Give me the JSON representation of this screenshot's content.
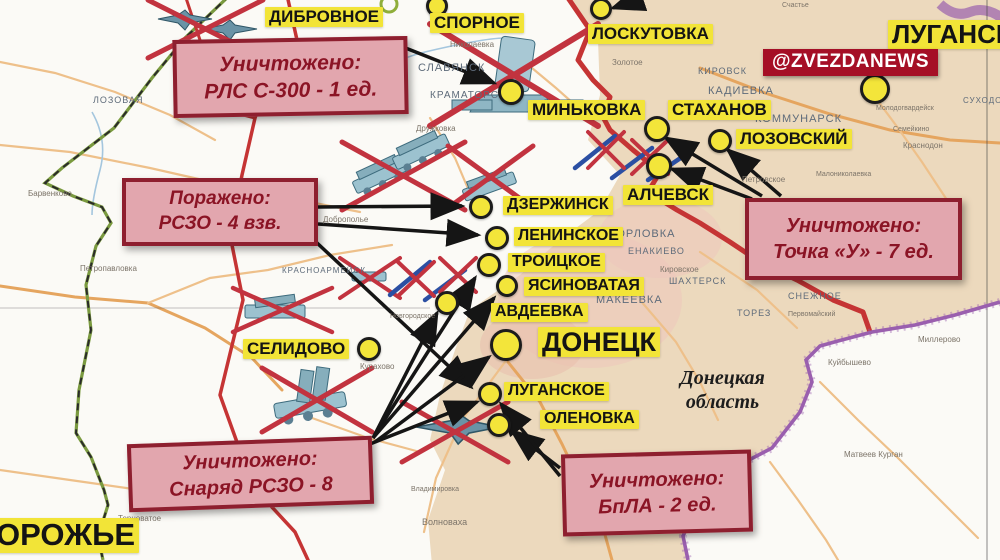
{
  "watermark": {
    "text": "@ZVEZDANEWS"
  },
  "corner_labels": {
    "top_right": "ЛУГАНСК",
    "bottom_left": "ОРОЖЬЕ"
  },
  "region_note": {
    "line1": "Донецкая",
    "line2": "область"
  },
  "colors": {
    "label_yellow": "#f2e437",
    "callout_bg": "#e2a6ae",
    "callout_border": "#8e1f2f",
    "callout_text": "#8b1425",
    "badge_bg": "#a50f26",
    "front_line_red": "#c53434",
    "state_border_purple": "#9a5fae",
    "territory_tan": "#ecd9bd",
    "equipment_teal": "#9cc2cf",
    "cross_red": "#c2333f",
    "arrow_black": "#151515"
  },
  "cities": [
    {
      "name": "ДИБРОВНОЕ"
    },
    {
      "name": "СПОРНОЕ"
    },
    {
      "name": "ЛОСКУТОВКА"
    },
    {
      "name": "МИНЬКОВКА"
    },
    {
      "name": "СТАХАНОВ"
    },
    {
      "name": "ЛОЗОВСКИЙ"
    },
    {
      "name": "АЛЧЕВСК"
    },
    {
      "name": "ДЗЕРЖИНСК"
    },
    {
      "name": "ЛЕНИНСКОЕ"
    },
    {
      "name": "ТРОИЦКОЕ"
    },
    {
      "name": "ЯСИНОВАТАЯ"
    },
    {
      "name": "АВДЕЕВКА"
    },
    {
      "name": "ДОНЕЦК"
    },
    {
      "name": "ЛУГАНСКОЕ"
    },
    {
      "name": "ОЛЕНОВКА"
    },
    {
      "name": "СЕЛИДОВО"
    }
  ],
  "callouts": [
    {
      "title": "Уничтожено:",
      "detail": "РЛС С-300 - 1 ед."
    },
    {
      "title": "Поражено:",
      "detail": "РСЗО - 4 взв."
    },
    {
      "title": "Уничтожено:",
      "detail": "Точка «У» - 7 ед."
    },
    {
      "title": "Уничтожено:",
      "detail": "Снаряд РСЗО - 8"
    },
    {
      "title": "Уничтожено:",
      "detail": "БпЛА - 2 ед."
    }
  ],
  "map_labels": [
    {
      "text": "Николаевка"
    },
    {
      "text": "СЛАВЯНСК"
    },
    {
      "text": "КРАМАТОРСК"
    },
    {
      "text": "Дружковка"
    },
    {
      "text": "Золотое"
    },
    {
      "text": "КИРОВСК"
    },
    {
      "text": "КАДИЕВКА"
    },
    {
      "text": "КОММУНАРСК"
    },
    {
      "text": "Молодогвардейск"
    },
    {
      "text": "Семейкино"
    },
    {
      "text": "Краснодон"
    },
    {
      "text": "СУХОДОЛЬСК"
    },
    {
      "text": "ГОРЛОВКА"
    },
    {
      "text": "ЕНАКИЕВО"
    },
    {
      "text": "Кировское"
    },
    {
      "text": "ШАХТЕРСК"
    },
    {
      "text": "МАКЕЕВКА"
    },
    {
      "text": "СНЕЖНОЕ"
    },
    {
      "text": "ТОРЕЗ"
    },
    {
      "text": "Первомайский"
    },
    {
      "text": "Петровское"
    },
    {
      "text": "Малониколаевка"
    },
    {
      "text": "Миллерово"
    },
    {
      "text": "Куйбышево"
    },
    {
      "text": "Матвеев Курган"
    },
    {
      "text": "Волноваха"
    },
    {
      "text": "Владимировка"
    },
    {
      "text": "Терноватое"
    },
    {
      "text": "ЛОЗОВАЯ"
    },
    {
      "text": "Барвенково"
    },
    {
      "text": "Петропавловка"
    },
    {
      "text": "КРАСНОАРМЕЙСК"
    },
    {
      "text": "Доброполье"
    },
    {
      "text": "Новгородское"
    },
    {
      "text": "Курахово"
    },
    {
      "text": "Счастье"
    }
  ]
}
